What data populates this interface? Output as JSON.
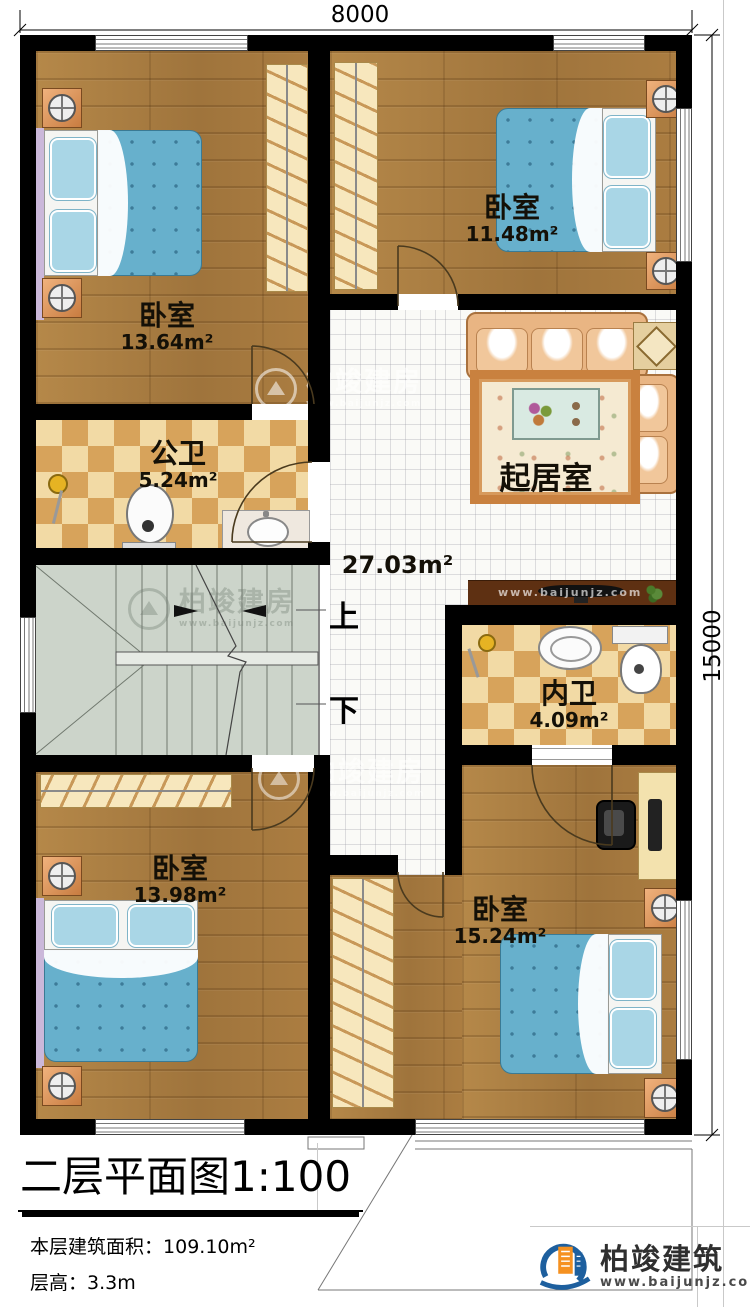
{
  "dimensions": {
    "width_top": "8000",
    "height_right": "15000"
  },
  "rooms": [
    {
      "name": "卧室",
      "area": "13.64m²"
    },
    {
      "name": "卧室",
      "area": "11.48m²"
    },
    {
      "name": "公卫",
      "area": "5.24m²"
    },
    {
      "name": "起居室",
      "area": "27.03m²"
    },
    {
      "name": "内卫",
      "area": "4.09m²"
    },
    {
      "name": "卧室",
      "area": "13.98m²"
    },
    {
      "name": "卧室",
      "area": "15.24m²"
    }
  ],
  "stairs": {
    "up_label": "上",
    "down_label": "下"
  },
  "title_block": {
    "title": "二层平面图",
    "scale": "1:100",
    "area_label": "本层建筑面积：",
    "area_value": "109.10m²",
    "height_label": "层高：",
    "height_value": "3.3m"
  },
  "branding": {
    "name": "柏竣建筑",
    "website": "www.baijunjz.com"
  },
  "watermark": {
    "text": "柏竣建房",
    "website": "www.baijunjz.com"
  },
  "colors": {
    "wall": "#000000",
    "wood_floor": "#a87c44",
    "bath_tile_dark": "#d7a35b",
    "bath_tile_light": "#f2daa5",
    "bed": "#67b0cc",
    "sofa": "#e9b583",
    "stairs": "#ccd4ca",
    "logo_blue": "#1d5f9e",
    "logo_orange": "#f59120"
  }
}
